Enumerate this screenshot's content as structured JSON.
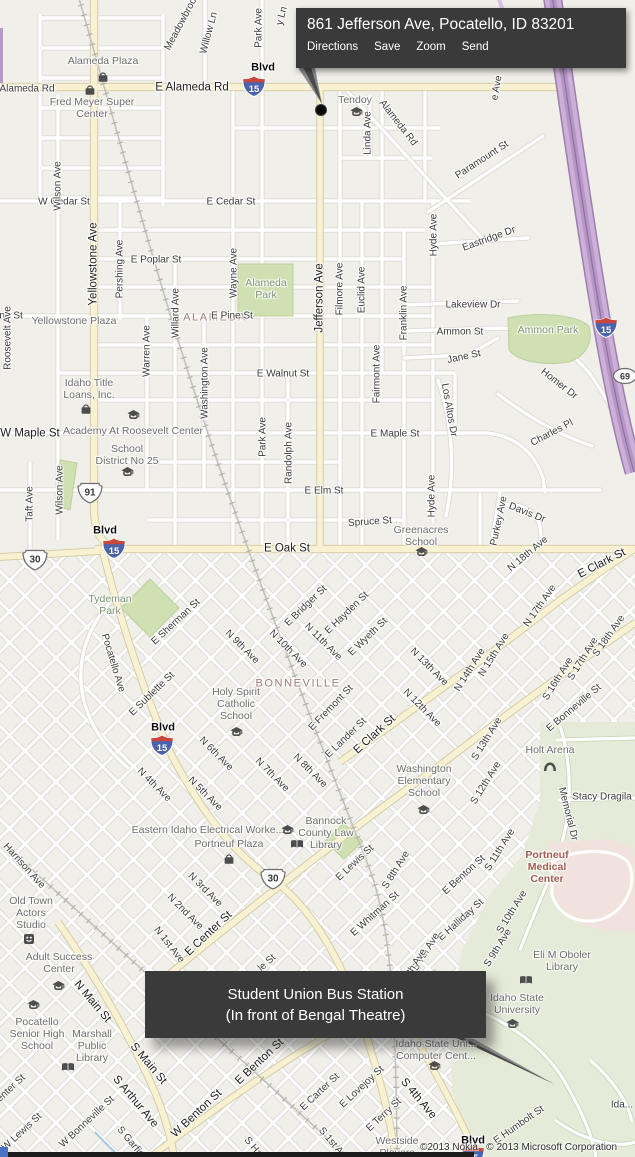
{
  "map": {
    "attribution": "©2013 Nokia   © 2013 Microsoft Corporation"
  },
  "tooltip": {
    "title": "861 Jefferson Ave, Pocatello, ID 83201",
    "links": [
      "Directions",
      "Save",
      "Zoom",
      "Send"
    ]
  },
  "callout": {
    "line1": "Student Union Bus Station",
    "line2": "(In front of Bengal Theatre)"
  },
  "colors": {
    "freeway": "#cdb0da",
    "major_road": "#f8f1d2",
    "park": "#cfe0b2",
    "campus": "#e5ebd8",
    "medical_area": "#f1e2de",
    "callout_bg": "#3a3a3a",
    "interstate_blue": "#4a63ae",
    "interstate_red": "#c8463c",
    "district_text": "#a27c7c"
  },
  "labels": [
    [
      "Alameda Rd",
      27,
      89,
      0,
      "st"
    ],
    [
      "E Alameda Rd",
      192,
      88,
      0,
      "road"
    ],
    [
      "Alameda Plaza",
      103,
      61,
      0,
      "poi"
    ],
    [
      "Fred Meyer Super\nCenter",
      92,
      108,
      0,
      "poi"
    ],
    [
      "Tendoy",
      355,
      100,
      0,
      "poi"
    ],
    [
      "Meadowbrook",
      182,
      22,
      -62,
      "st"
    ],
    [
      "Willow Ln",
      209,
      33,
      -75,
      "st"
    ],
    [
      "Park Ave",
      259,
      28,
      -90,
      "st"
    ],
    [
      "y Ln",
      282,
      16,
      -75,
      "st"
    ],
    [
      "Blvd",
      263,
      68,
      0,
      "blvd"
    ],
    [
      "Linda Ave",
      368,
      133,
      -90,
      "st"
    ],
    [
      "Alameda Rd",
      398,
      123,
      52,
      "st"
    ],
    [
      "Paramount St",
      482,
      160,
      -33,
      "st"
    ],
    [
      "e Ave",
      497,
      88,
      -80,
      "st"
    ],
    [
      "Hyde Ave",
      434,
      235,
      -90,
      "st"
    ],
    [
      "Eastridge Dr",
      489,
      239,
      -20,
      "st"
    ],
    [
      "Lakeview Dr",
      473,
      305,
      0,
      "st"
    ],
    [
      "W Cedar St",
      64,
      202,
      0,
      "st"
    ],
    [
      "E Cedar St",
      231,
      202,
      0,
      "st"
    ],
    [
      "Wilson Ave",
      58,
      186,
      -90,
      "st"
    ],
    [
      "Yellowstone Ave",
      94,
      264,
      -90,
      "road"
    ],
    [
      "Pershing Ave",
      120,
      269,
      -90,
      "st"
    ],
    [
      "E Poplar St",
      156,
      260,
      0,
      "st"
    ],
    [
      "Wayne Ave",
      234,
      273,
      -90,
      "st"
    ],
    [
      "Alameda\nPark",
      266,
      289,
      0,
      "park"
    ],
    [
      "ALAMEDA",
      215,
      318,
      0,
      "district"
    ],
    [
      "E Pine St",
      232,
      316,
      0,
      "st"
    ],
    [
      "ine St",
      10,
      316,
      0,
      "st"
    ],
    [
      "Yellowstone Plaza",
      74,
      321,
      0,
      "poi"
    ],
    [
      "Warren Ave",
      147,
      351,
      -90,
      "st"
    ],
    [
      "Willard Ave",
      176,
      313,
      -90,
      "st"
    ],
    [
      "Washington Ave",
      205,
      383,
      -90,
      "st"
    ],
    [
      "Jefferson Ave",
      320,
      298,
      -90,
      "road"
    ],
    [
      "Filmore Ave",
      340,
      289,
      -90,
      "st"
    ],
    [
      "Euclid Ave",
      362,
      290,
      -90,
      "st"
    ],
    [
      "Franklin Ave",
      404,
      313,
      -90,
      "st"
    ],
    [
      "Fairmont Ave",
      377,
      374,
      -90,
      "st"
    ],
    [
      "E Walnut St",
      283,
      374,
      0,
      "st"
    ],
    [
      "Ammon St",
      460,
      332,
      0,
      "st"
    ],
    [
      "Ammon Park",
      548,
      330,
      0,
      "park"
    ],
    [
      "Jane St",
      464,
      357,
      -12,
      "st"
    ],
    [
      "Homer Dr",
      559,
      384,
      38,
      "st"
    ],
    [
      "Charles Pl",
      552,
      433,
      -28,
      "st"
    ],
    [
      "Los Altos Dr",
      449,
      410,
      80,
      "st"
    ],
    [
      "Roosevelt Ave",
      8,
      338,
      -90,
      "st"
    ],
    [
      "Idaho Title\nLoans, Inc.",
      89,
      389,
      0,
      "poi"
    ],
    [
      "W Maple St",
      30,
      434,
      0,
      "road"
    ],
    [
      "Academy At Roosevelt Center",
      133,
      431,
      0,
      "poi"
    ],
    [
      "School\nDistrict No 25",
      127,
      455,
      0,
      "poi"
    ],
    [
      "E Maple St",
      395,
      434,
      0,
      "st"
    ],
    [
      "Park Ave",
      263,
      437,
      -90,
      "st"
    ],
    [
      "Randolph Ave",
      289,
      453,
      -90,
      "st"
    ],
    [
      "Hyde Ave",
      432,
      496,
      -90,
      "st"
    ],
    [
      "E Elm St",
      324,
      491,
      0,
      "st"
    ],
    [
      "Wilson Ave",
      60,
      490,
      -90,
      "st"
    ],
    [
      "Taft Ave",
      30,
      504,
      -90,
      "st"
    ],
    [
      "Spruce St",
      370,
      522,
      -4,
      "st"
    ],
    [
      "Greenacres\nSchool",
      421,
      536,
      0,
      "poi"
    ],
    [
      "Purkey Ave",
      499,
      521,
      -78,
      "st"
    ],
    [
      "Davis Dr",
      527,
      513,
      22,
      "st"
    ],
    [
      "N 18th Ave",
      528,
      554,
      -40,
      "st"
    ],
    [
      "Blvd",
      105,
      531,
      0,
      "blvd"
    ],
    [
      "E Oak St",
      287,
      549,
      0,
      "road"
    ],
    [
      "E Clark St",
      602,
      564,
      -27,
      "road"
    ],
    [
      "Tydeman\nPark",
      110,
      605,
      0,
      "park"
    ],
    [
      "E Sherman St",
      176,
      622,
      -43,
      "st"
    ],
    [
      "E Bridger St",
      306,
      606,
      -44,
      "st"
    ],
    [
      "E Hayden St",
      347,
      613,
      -44,
      "st"
    ],
    [
      "E Wyeth St",
      368,
      637,
      -44,
      "st"
    ],
    [
      "N 9th Ave",
      242,
      647,
      45,
      "st"
    ],
    [
      "N 10th Ave",
      288,
      649,
      45,
      "st"
    ],
    [
      "N 11th Ave",
      323,
      642,
      45,
      "st"
    ],
    [
      "N 13th Ave",
      429,
      667,
      45,
      "st"
    ],
    [
      "N 14th Ave",
      470,
      670,
      -58,
      "st"
    ],
    [
      "N 15th Ave",
      494,
      655,
      -58,
      "st"
    ],
    [
      "N 17th Ave",
      540,
      606,
      -55,
      "st"
    ],
    [
      "S 18th Ave",
      609,
      636,
      -55,
      "st"
    ],
    [
      "S 17th Ave",
      583,
      659,
      -58,
      "st"
    ],
    [
      "S 16th Ave",
      558,
      679,
      -58,
      "st"
    ],
    [
      "E Bonneville St",
      574,
      708,
      -40,
      "st"
    ],
    [
      "E Sublette St",
      152,
      694,
      -44,
      "st"
    ],
    [
      "Pocatello Ave",
      113,
      663,
      73,
      "st"
    ],
    [
      "BONNEVILLE",
      298,
      684,
      0,
      "district"
    ],
    [
      "Holy Spirit\nCatholic\nSchool",
      236,
      704,
      0,
      "poi"
    ],
    [
      "E Fremont St",
      331,
      708,
      -46,
      "st"
    ],
    [
      "E Lander St",
      346,
      738,
      -44,
      "st"
    ],
    [
      "N 12th Ave",
      422,
      708,
      45,
      "st"
    ],
    [
      "S 13th Ave",
      487,
      739,
      -58,
      "st"
    ],
    [
      "Blvd",
      163,
      728,
      0,
      "blvd"
    ],
    [
      "N 6th Ave",
      216,
      754,
      45,
      "st"
    ],
    [
      "N 7th Ave",
      272,
      775,
      45,
      "st"
    ],
    [
      "N 8th Ave",
      310,
      771,
      45,
      "st"
    ],
    [
      "N 4th Ave",
      154,
      785,
      45,
      "st"
    ],
    [
      "N 5th Ave",
      205,
      794,
      45,
      "st"
    ],
    [
      "E Clark St",
      375,
      735,
      -42,
      "road"
    ],
    [
      "Holt Arena",
      550,
      750,
      0,
      "poi"
    ],
    [
      "Washington\nElementary\nSchool",
      424,
      781,
      0,
      "poi"
    ],
    [
      "S 12th Ave",
      486,
      783,
      -58,
      "st"
    ],
    [
      "Stacy Dragila",
      602,
      797,
      0,
      "st"
    ],
    [
      "Memorial Dr",
      568,
      814,
      76,
      "st"
    ],
    [
      "Bannock\nCounty Law\nLibrary",
      326,
      833,
      0,
      "poi"
    ],
    [
      "Eastern Idaho Electrical Worke...",
      208,
      830,
      0,
      "poi"
    ],
    [
      "Portneuf Plaza",
      229,
      844,
      0,
      "poi"
    ],
    [
      "E Lewis St",
      355,
      863,
      -43,
      "st"
    ],
    [
      "S 8th Ave",
      396,
      870,
      -58,
      "st"
    ],
    [
      "S 11th Ave",
      500,
      850,
      -58,
      "st"
    ],
    [
      "Portneuf\nMedical\nCenter",
      547,
      867,
      0,
      "med"
    ],
    [
      "Harrison Ave",
      24,
      866,
      48,
      "st"
    ],
    [
      "Old Town\nActors\nStudio",
      31,
      913,
      0,
      "poi"
    ],
    [
      "E Center St",
      209,
      934,
      -43,
      "road"
    ],
    [
      "N 3rd Ave",
      205,
      890,
      45,
      "st"
    ],
    [
      "N 2nd Ave",
      185,
      912,
      45,
      "st"
    ],
    [
      "N 1st Ave",
      169,
      945,
      52,
      "st"
    ],
    [
      "E Whitman St",
      375,
      914,
      -42,
      "st"
    ],
    [
      "E Benton St",
      464,
      875,
      -42,
      "st"
    ],
    [
      "E Halliday St",
      461,
      920,
      -42,
      "st"
    ],
    [
      "S 10th Ave",
      512,
      912,
      -58,
      "st"
    ],
    [
      "S 9th Ave",
      498,
      948,
      -58,
      "st"
    ],
    [
      "S 7th Ave",
      426,
      952,
      -58,
      "st"
    ],
    [
      "S 6th Ave",
      413,
      968,
      -58,
      "st"
    ],
    [
      "le St",
      267,
      963,
      -42,
      "st"
    ],
    [
      "Adult Success\nCenter",
      59,
      963,
      0,
      "poi"
    ],
    [
      "N Main St",
      92,
      1002,
      50,
      "road"
    ],
    [
      "Eli M Oboler\nLibrary",
      562,
      961,
      0,
      "poi"
    ],
    [
      "Idaho State\nUniversity",
      517,
      1004,
      0,
      "poi"
    ],
    [
      "Pocatello\nSenior High\nSchool",
      37,
      1034,
      0,
      "poi"
    ],
    [
      "Marshall\nPublic\nLibrary",
      92,
      1046,
      0,
      "poi"
    ],
    [
      "S Main St",
      148,
      1064,
      50,
      "road"
    ],
    [
      "Idaho State Uni...\nComputer Cent...",
      436,
      1050,
      0,
      "poi"
    ],
    [
      "S Arthur Ave",
      135,
      1102,
      50,
      "road"
    ],
    [
      "W Bonneville St",
      87,
      1122,
      -43,
      "st"
    ],
    [
      "W Lewis St",
      22,
      1132,
      -43,
      "st"
    ],
    [
      "W Center St",
      4,
      1095,
      -43,
      "st"
    ],
    [
      "S Garfield",
      133,
      1145,
      50,
      "st"
    ],
    [
      "W Benton St",
      197,
      1114,
      -43,
      "road"
    ],
    [
      "E Benton St",
      260,
      1062,
      -43,
      "road"
    ],
    [
      "E Carter St",
      320,
      1092,
      -43,
      "st"
    ],
    [
      "E Lovejoy St",
      362,
      1087,
      -43,
      "st"
    ],
    [
      "E Terry St",
      384,
      1115,
      -43,
      "st"
    ],
    [
      "S 4th Ave",
      418,
      1099,
      50,
      "road"
    ],
    [
      "E Humbolt St",
      519,
      1125,
      -35,
      "st"
    ],
    [
      "S 1st Ave",
      334,
      1145,
      50,
      "st"
    ],
    [
      "S Ha",
      253,
      1147,
      50,
      "st"
    ],
    [
      "Westside\nPlayers",
      397,
      1147,
      0,
      "poi"
    ],
    [
      "Ida...",
      622,
      1105,
      0,
      "st"
    ],
    [
      "Blvd",
      473,
      1141,
      0,
      "blvd"
    ]
  ],
  "shields": [
    [
      "i",
      "15",
      255,
      87
    ],
    [
      "i",
      "15",
      115,
      549
    ],
    [
      "i",
      "15",
      163,
      746
    ],
    [
      "i",
      "15",
      607,
      328
    ],
    [
      "i",
      "15",
      474,
      1156
    ],
    [
      "us",
      "30",
      35,
      560
    ],
    [
      "us",
      "30",
      273,
      879
    ],
    [
      "us",
      "91",
      90,
      493
    ],
    [
      "el",
      "69",
      625,
      378
    ]
  ],
  "icons": [
    [
      "shop",
      103,
      75
    ],
    [
      "shop",
      90,
      88
    ],
    [
      "school",
      356,
      110
    ],
    [
      "school",
      133,
      413
    ],
    [
      "school",
      127,
      470
    ],
    [
      "shop",
      86,
      407
    ],
    [
      "school",
      421,
      550
    ],
    [
      "school",
      236,
      730
    ],
    [
      "school",
      423,
      808
    ],
    [
      "school",
      287,
      828
    ],
    [
      "book",
      296,
      841
    ],
    [
      "shop",
      229,
      857
    ],
    [
      "stadium",
      549,
      764
    ],
    [
      "book",
      67,
      1064
    ],
    [
      "theater",
      29,
      937
    ],
    [
      "school",
      58,
      984
    ],
    [
      "school",
      33,
      1003
    ],
    [
      "book",
      525,
      977
    ],
    [
      "school",
      512,
      1022
    ],
    [
      "school",
      434,
      1064
    ]
  ]
}
